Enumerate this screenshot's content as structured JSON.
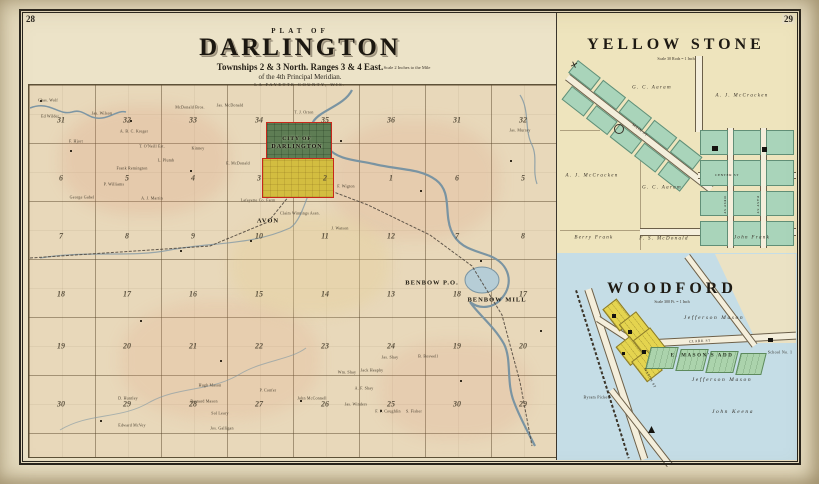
{
  "page": {
    "left_page_number": "28",
    "right_page_number": "29"
  },
  "main_map": {
    "kicker": "PLAT OF",
    "title": "DARLINGTON",
    "subtitle1": "Townships 2 & 3 North. Ranges 3 & 4 East.",
    "subtitle2": "of the 4th Principal Meridian.",
    "subtitle3": "LA FAYETTE COUNTY, WIS.",
    "scale_note": "Scale 2 Inches to the Mile",
    "city": {
      "line1": "CITY OF",
      "line2": "DARLINGTON"
    },
    "place_labels": [
      {
        "t": "AVON",
        "x": 268,
        "y": 221
      },
      {
        "t": "BENBOW P.O.",
        "x": 432,
        "y": 283
      },
      {
        "t": "BENBOW MILL",
        "x": 497,
        "y": 300
      }
    ],
    "section_numbers": [
      {
        "t": "31",
        "x": 61,
        "y": 120
      },
      {
        "t": "32",
        "x": 127,
        "y": 120
      },
      {
        "t": "33",
        "x": 193,
        "y": 120
      },
      {
        "t": "34",
        "x": 259,
        "y": 120
      },
      {
        "t": "35",
        "x": 325,
        "y": 120
      },
      {
        "t": "36",
        "x": 391,
        "y": 120
      },
      {
        "t": "31",
        "x": 457,
        "y": 120
      },
      {
        "t": "32",
        "x": 523,
        "y": 120
      },
      {
        "t": "6",
        "x": 61,
        "y": 178
      },
      {
        "t": "5",
        "x": 127,
        "y": 178
      },
      {
        "t": "4",
        "x": 193,
        "y": 178
      },
      {
        "t": "3",
        "x": 259,
        "y": 178
      },
      {
        "t": "2",
        "x": 325,
        "y": 178
      },
      {
        "t": "1",
        "x": 391,
        "y": 178
      },
      {
        "t": "6",
        "x": 457,
        "y": 178
      },
      {
        "t": "5",
        "x": 523,
        "y": 178
      },
      {
        "t": "7",
        "x": 61,
        "y": 236
      },
      {
        "t": "8",
        "x": 127,
        "y": 236
      },
      {
        "t": "9",
        "x": 193,
        "y": 236
      },
      {
        "t": "10",
        "x": 259,
        "y": 236
      },
      {
        "t": "11",
        "x": 325,
        "y": 236
      },
      {
        "t": "12",
        "x": 391,
        "y": 236
      },
      {
        "t": "7",
        "x": 457,
        "y": 236
      },
      {
        "t": "8",
        "x": 523,
        "y": 236
      },
      {
        "t": "18",
        "x": 61,
        "y": 294
      },
      {
        "t": "17",
        "x": 127,
        "y": 294
      },
      {
        "t": "16",
        "x": 193,
        "y": 294
      },
      {
        "t": "15",
        "x": 259,
        "y": 294
      },
      {
        "t": "14",
        "x": 325,
        "y": 294
      },
      {
        "t": "13",
        "x": 391,
        "y": 294
      },
      {
        "t": "18",
        "x": 457,
        "y": 294
      },
      {
        "t": "17",
        "x": 523,
        "y": 294
      },
      {
        "t": "19",
        "x": 61,
        "y": 346
      },
      {
        "t": "20",
        "x": 127,
        "y": 346
      },
      {
        "t": "21",
        "x": 193,
        "y": 346
      },
      {
        "t": "22",
        "x": 259,
        "y": 346
      },
      {
        "t": "23",
        "x": 325,
        "y": 346
      },
      {
        "t": "24",
        "x": 391,
        "y": 346
      },
      {
        "t": "19",
        "x": 457,
        "y": 346
      },
      {
        "t": "20",
        "x": 523,
        "y": 346
      },
      {
        "t": "30",
        "x": 61,
        "y": 404
      },
      {
        "t": "29",
        "x": 127,
        "y": 404
      },
      {
        "t": "28",
        "x": 193,
        "y": 404
      },
      {
        "t": "27",
        "x": 259,
        "y": 404
      },
      {
        "t": "26",
        "x": 325,
        "y": 404
      },
      {
        "t": "25",
        "x": 391,
        "y": 404
      },
      {
        "t": "30",
        "x": 457,
        "y": 404
      },
      {
        "t": "29",
        "x": 523,
        "y": 404
      }
    ],
    "owner_names": [
      {
        "t": "Chas. Wolf",
        "x": 48,
        "y": 100
      },
      {
        "t": "Ed Wilder",
        "x": 50,
        "y": 116
      },
      {
        "t": "Jas. Wilson",
        "x": 102,
        "y": 113
      },
      {
        "t": "McDonald Bros.",
        "x": 190,
        "y": 107
      },
      {
        "t": "Jas. McDonald",
        "x": 230,
        "y": 105
      },
      {
        "t": "T. J. Orton",
        "x": 304,
        "y": 112
      },
      {
        "t": "A. B. C. Kreger",
        "x": 134,
        "y": 131
      },
      {
        "t": "F. Hjort",
        "x": 76,
        "y": 141
      },
      {
        "t": "T. O'Neill Est.",
        "x": 152,
        "y": 146
      },
      {
        "t": "Kinney",
        "x": 198,
        "y": 148
      },
      {
        "t": "L. Plumb",
        "x": 166,
        "y": 160
      },
      {
        "t": "Frank Remington",
        "x": 132,
        "y": 168
      },
      {
        "t": "E. McDonald",
        "x": 238,
        "y": 163
      },
      {
        "t": "P. Williams",
        "x": 114,
        "y": 184
      },
      {
        "t": "Lafayette Co. Farm",
        "x": 258,
        "y": 200
      },
      {
        "t": "A. J. Martin",
        "x": 152,
        "y": 198
      },
      {
        "t": "George Gabel",
        "x": 82,
        "y": 197
      },
      {
        "t": "Jas. Murray",
        "x": 520,
        "y": 130
      },
      {
        "t": "F. Wigton",
        "x": 346,
        "y": 186
      },
      {
        "t": "J. Watson",
        "x": 340,
        "y": 228
      },
      {
        "t": "Claim Winnings Assn.",
        "x": 300,
        "y": 213
      },
      {
        "t": "Jas. Shay",
        "x": 390,
        "y": 357
      },
      {
        "t": "Jack Heaphy",
        "x": 372,
        "y": 370
      },
      {
        "t": "A. F. Shay",
        "x": 364,
        "y": 388
      },
      {
        "t": "B. Boswell",
        "x": 428,
        "y": 356
      },
      {
        "t": "Jas. Winders",
        "x": 356,
        "y": 404
      },
      {
        "t": "F. F. Coughlin",
        "x": 388,
        "y": 411
      },
      {
        "t": "S. Fisher",
        "x": 414,
        "y": 411
      },
      {
        "t": "John McConnell",
        "x": 312,
        "y": 398
      },
      {
        "t": "Wm. Shay",
        "x": 347,
        "y": 372
      },
      {
        "t": "D. Huntley",
        "x": 128,
        "y": 398
      },
      {
        "t": "Hugh Mason",
        "x": 210,
        "y": 385
      },
      {
        "t": "Bernard Mason",
        "x": 204,
        "y": 401
      },
      {
        "t": "Edward McVey",
        "x": 132,
        "y": 425
      },
      {
        "t": "Jos. Galligan",
        "x": 222,
        "y": 428
      },
      {
        "t": "Sol Leary",
        "x": 220,
        "y": 413
      },
      {
        "t": "P. Confer",
        "x": 268,
        "y": 390
      }
    ]
  },
  "yellow_stone": {
    "title": "YELLOW STONE",
    "scale": "Scale 30 Rods = 1 Inch",
    "labels": [
      {
        "t": "G. C. Aaram",
        "x": 652,
        "y": 88
      },
      {
        "t": "A. J. McCracken",
        "x": 742,
        "y": 96
      },
      {
        "t": "A. J. McCracken",
        "x": 592,
        "y": 176
      },
      {
        "t": "G. C. Aaram",
        "x": 662,
        "y": 188
      },
      {
        "t": "Berry Frank",
        "x": 594,
        "y": 238
      },
      {
        "t": "F. S. McDonald",
        "x": 664,
        "y": 239
      },
      {
        "t": "John Frank",
        "x": 752,
        "y": 238
      }
    ],
    "streets": [
      {
        "t": "MAIN ST",
        "x": 640,
        "y": 130,
        "r": 38
      },
      {
        "t": "CENTER ST",
        "x": 727,
        "y": 175,
        "r": 0
      },
      {
        "t": "WEST ST",
        "x": 725,
        "y": 205,
        "r": 90
      },
      {
        "t": "EAST ST",
        "x": 758,
        "y": 205,
        "r": 90
      }
    ]
  },
  "woodford": {
    "title": "WOODFORD",
    "scale": "Scale 300 Ft. = 1 Inch",
    "labels": [
      {
        "t": "Jefferson Mason",
        "x": 714,
        "y": 318
      },
      {
        "t": "E. MASON'S ADD",
        "x": 702,
        "y": 356,
        "c": "add"
      },
      {
        "t": "Jefferson Mason",
        "x": 722,
        "y": 380
      },
      {
        "t": "Byram Pickett",
        "x": 597,
        "y": 397,
        "c": "sm"
      },
      {
        "t": "John Keena",
        "x": 733,
        "y": 412
      },
      {
        "t": "School No. 1",
        "x": 780,
        "y": 352,
        "c": "sm"
      }
    ],
    "streets": [
      {
        "t": "CLARK ST",
        "x": 700,
        "y": 341,
        "r": -3
      },
      {
        "t": "MASON ST",
        "x": 650,
        "y": 378,
        "r": 62
      }
    ]
  }
}
